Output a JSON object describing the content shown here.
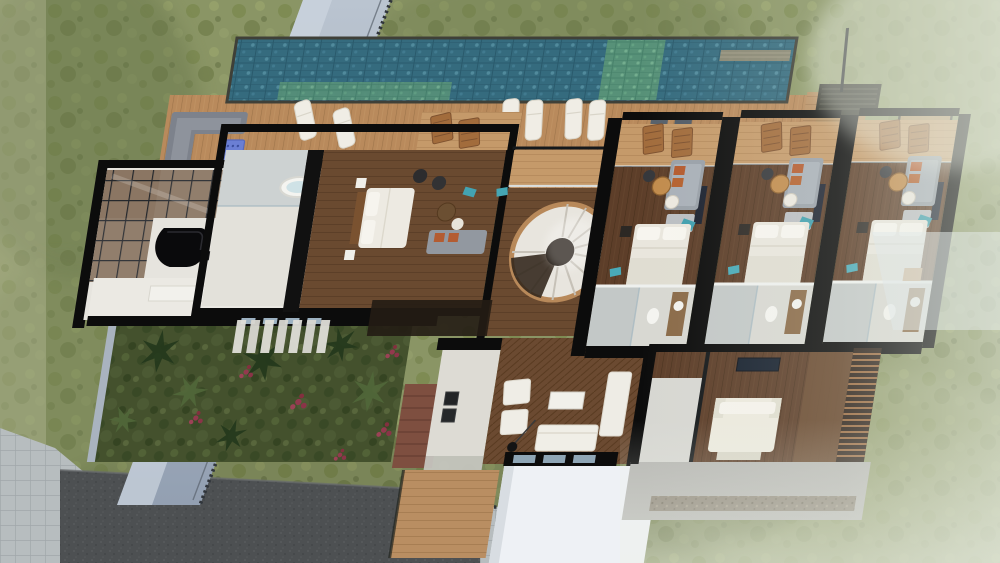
{
  "scene": {
    "title": "Aerial cutaway 3D render of a modern villa floor plan",
    "type": "architectural-dollhouse-render",
    "view": "top-down aerial, section-cut walls shown black, slight perspective lean",
    "no_visible_text": true
  },
  "environment": {
    "ground": "mottled olive-green grass, hazy/washed-out toward right and bottom-right",
    "boundary_wall": "blue-gray concrete wall running diagonally along the left with dark fence edge",
    "driveway": "dark asphalt rectangle bottom-left",
    "paver_apron": "light gray paver grid around driveway",
    "fence_line": "thin dark picket fence between garden and pavers"
  },
  "outdoor": {
    "pool": {
      "description": "linear lap pool across the top with glass-tile finish",
      "sections": [
        "deep blue tile",
        "green tile plunge section",
        "green tile baja shelf",
        "right blue section with stone coping band"
      ],
      "water_deep_color": "#356b7e",
      "water_green_color": "#579178"
    },
    "deck": {
      "description": "wide timber pool deck",
      "sun_loungers": 6,
      "l_shaped_sofa": 1,
      "blue_cube_table": 1,
      "gray_deck_mats": 2,
      "louvered_grate_platform": "dark slatted platform at pool's right end",
      "side_walkway": "hazy timber walkway with railings, far right"
    }
  },
  "rooms": [
    {
      "id": "master-suite",
      "name": "Master suite",
      "furniture": [
        "freestanding oval bathtub",
        "glass shower",
        "double bed with white duvet",
        "gray sofa with orange cushions",
        "two round side tables",
        "two dark stools",
        "teal accent rug",
        "balcony with two timber chairs"
      ]
    },
    {
      "id": "piano-lounge",
      "name": "Piano lounge",
      "furniture": [
        "black grand piano",
        "piano bench",
        "glazed roof corner with dark mullions",
        "white marble floor"
      ]
    },
    {
      "id": "kitchen",
      "name": "Kitchen",
      "furniture": [
        "long white island counter",
        "sink with faucet",
        "dark cooktop",
        "window band on south wall"
      ]
    },
    {
      "id": "garden-courtyard",
      "name": "Garden courtyard",
      "furniture": [
        "tropical palms",
        "red flowering shrubs",
        "white louver pergola slats",
        "brick path",
        "timber steps"
      ]
    },
    {
      "id": "stair-hall",
      "name": "Stair hall",
      "furniture": [
        "white spiral staircase with timber rim",
        "upper timber walkway with glass rail",
        "white landing"
      ]
    },
    {
      "id": "living-room",
      "name": "Living room",
      "furniture": [
        "two white armchairs",
        "white sofa",
        "long white bench",
        "white coffee table",
        "black floor lamp",
        "utility room with stacked ovens",
        "window band",
        "white flat roof below"
      ]
    },
    {
      "id": "guest-suite-1",
      "name": "Guest suite 1",
      "furniture": [
        "balcony with timber chairs and glass rail",
        "gray loveseat with orange cushions",
        "round tan and white side tables",
        "teal accents",
        "double bed with white bedding",
        "bathroom with shower, WC and timber vanity"
      ]
    },
    {
      "id": "guest-suite-2",
      "name": "Guest suite 2",
      "furniture": [
        "balcony with timber chairs and glass rail",
        "gray loveseat with orange cushions",
        "round tan and white side tables",
        "teal accents",
        "double bed with white bedding",
        "bathroom with shower, WC and timber vanity"
      ]
    },
    {
      "id": "guest-suite-3",
      "name": "Guest suite 3",
      "furniture": [
        "balcony with timber chairs and glass rail",
        "gray loveseat with orange cushions",
        "round tan and white side tables",
        "teal accents",
        "double bed with white bedding",
        "bathroom with shower, WC and timber vanity"
      ]
    },
    {
      "id": "lower-bedroom",
      "name": "Lower bedroom",
      "furniture": [
        "bed with white bedding and wing headboard",
        "wall TV",
        "timber slat privacy screen",
        "small bathroom",
        "concrete terrace with gravel strip"
      ]
    }
  ],
  "palette": {
    "grass": "#8a9565",
    "grass_dark": "#66744a",
    "grass_haze": "#e9eee4",
    "pool_deep": "#356b7e",
    "pool_green": "#579178",
    "deck_wood": "#b98a5c",
    "floor_wood_dark": "#5d3e29",
    "cut_wall_black": "#0c0c0c",
    "white_wall": "#ececea",
    "bath_gray": "#c6cac9",
    "sofa_gray": "#99a0a8",
    "cushion_orange": "#b45a2e",
    "teal_accent": "#3f9fae",
    "blue_cube": "#6b7fd4",
    "boundary_wall": "#a9b6c6",
    "driveway": "#4d5052",
    "paver": "#b7bdbf",
    "garden_green": "#44512d",
    "flower_red": "#93394e"
  }
}
